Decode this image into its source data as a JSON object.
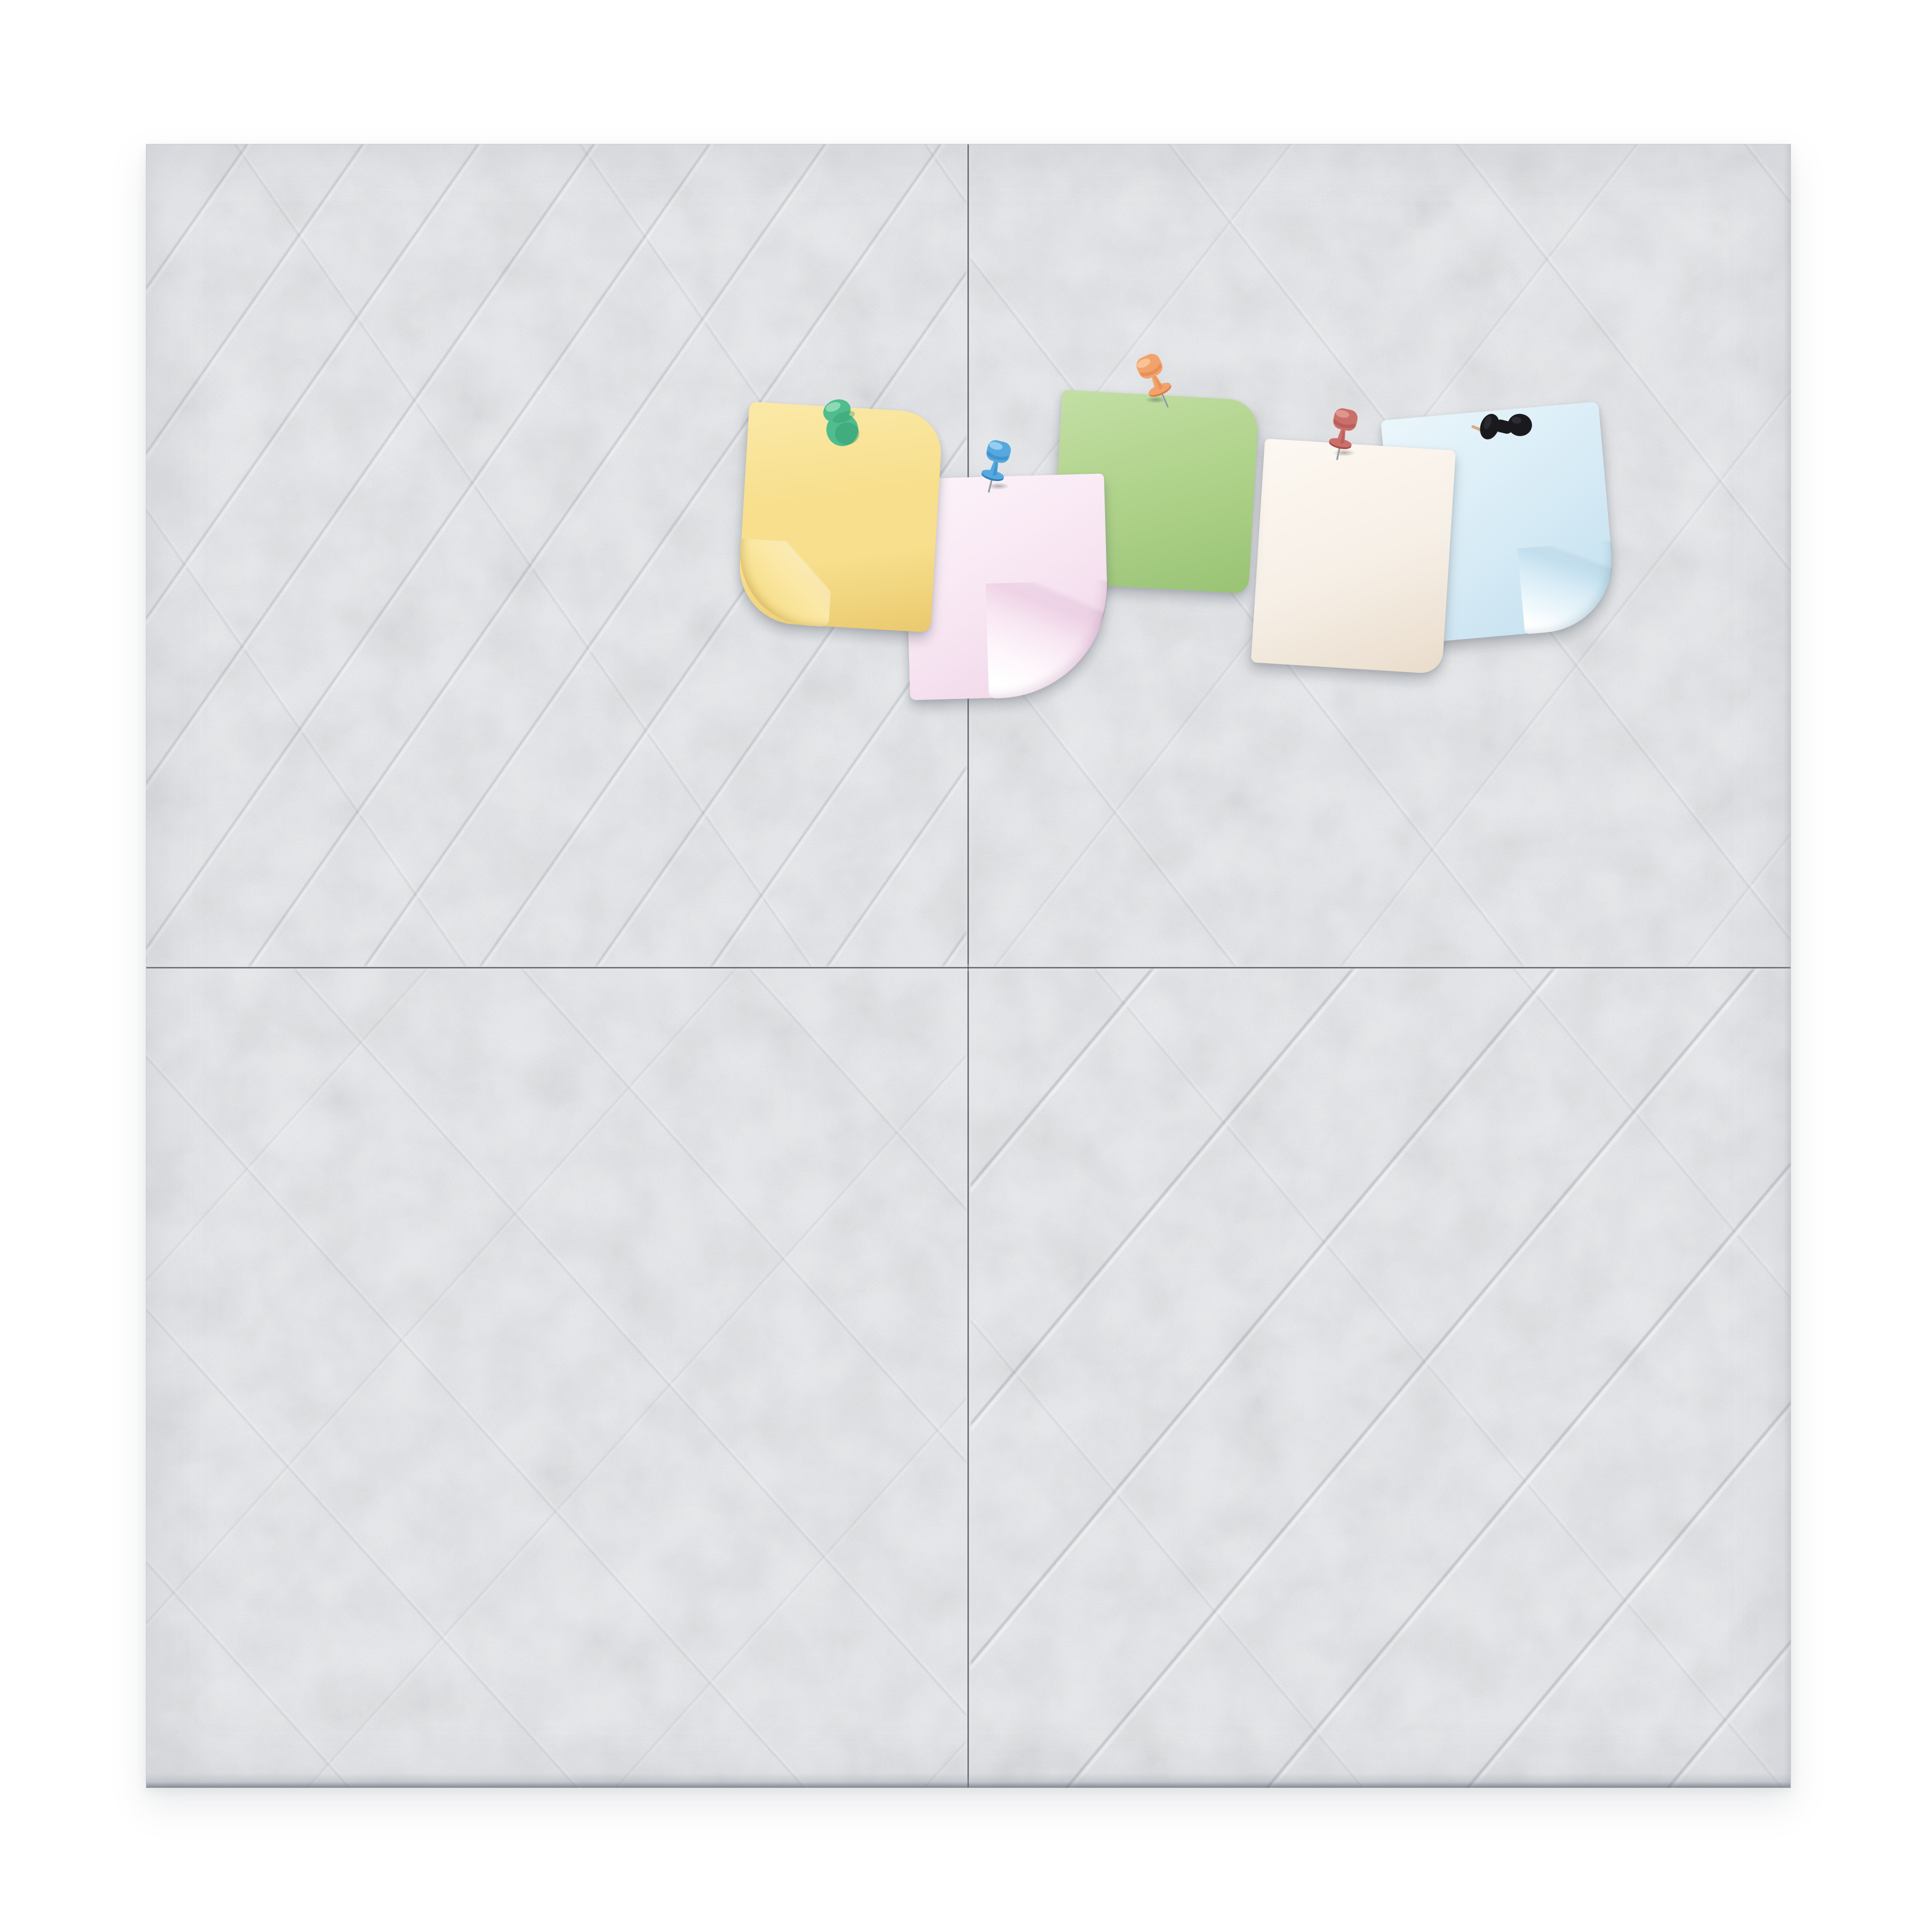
{
  "board": {
    "page_background": "#ffffff",
    "felt_base": "#e9ebee",
    "felt_fleck": "#b6bcc5",
    "crease_light": "#f4f5f7",
    "crease_shadow": "#9aa1ac",
    "seam_color": "#44484f",
    "edge_color": "#aab0b8",
    "tiles": [
      {
        "position": "top-left",
        "crease_direction": "diagonal-rising",
        "crease_spacing_px": 190
      },
      {
        "position": "top-right",
        "crease_direction": "crosshatch-faint",
        "crease_spacing_px": 430
      },
      {
        "position": "bottom-left",
        "crease_direction": "crosshatch-faint",
        "crease_spacing_px": 320
      },
      {
        "position": "bottom-right",
        "crease_direction": "diagonal-rising",
        "crease_spacing_px": 300
      }
    ]
  },
  "notes": [
    {
      "id": "yellow",
      "color": "#f7df8d",
      "color_deep": "#eac96e",
      "color_light": "#fbe9a8",
      "curled_corner": "bottom-left",
      "pin": {
        "style": "round-head",
        "color": "#4fbd8d",
        "color_dark": "#2f9468",
        "color_light": "#93dcb8"
      }
    },
    {
      "id": "pink",
      "color": "#f8e7f3",
      "color_deep": "#eed3e6",
      "color_light": "#fdf4fa",
      "curled_corner": "bottom-right",
      "pin": {
        "style": "pushpin",
        "color": "#55a9e0",
        "color_dark": "#2f7fb5",
        "color_light": "#a3d3f1"
      }
    },
    {
      "id": "green",
      "color": "#aed289",
      "color_deep": "#99c375",
      "color_light": "#c3dfa5",
      "curled_corner": "none",
      "pin": {
        "style": "pushpin-tilted",
        "color": "#f2a36c",
        "color_dark": "#d97f45",
        "color_light": "#fac9a0"
      }
    },
    {
      "id": "cream",
      "color": "#f6efe6",
      "color_deep": "#e9dccb",
      "color_light": "#fdf8f2",
      "curled_corner": "bottom-right-slight",
      "pin": {
        "style": "pushpin",
        "color": "#cb6f6a",
        "color_dark": "#a64e4c",
        "color_light": "#e49d97"
      }
    },
    {
      "id": "blue",
      "color": "#d8ecf6",
      "color_deep": "#c2dfee",
      "color_light": "#eaf6fb",
      "curled_corner": "bottom-right",
      "pin": {
        "style": "spool-side",
        "color": "#1a1a1e",
        "color_dark": "#060607",
        "color_light": "#3e3e46",
        "needle_color": "#d9a983"
      }
    }
  ],
  "counts": {
    "tiles": 4,
    "notes": 5,
    "pins": 5
  }
}
